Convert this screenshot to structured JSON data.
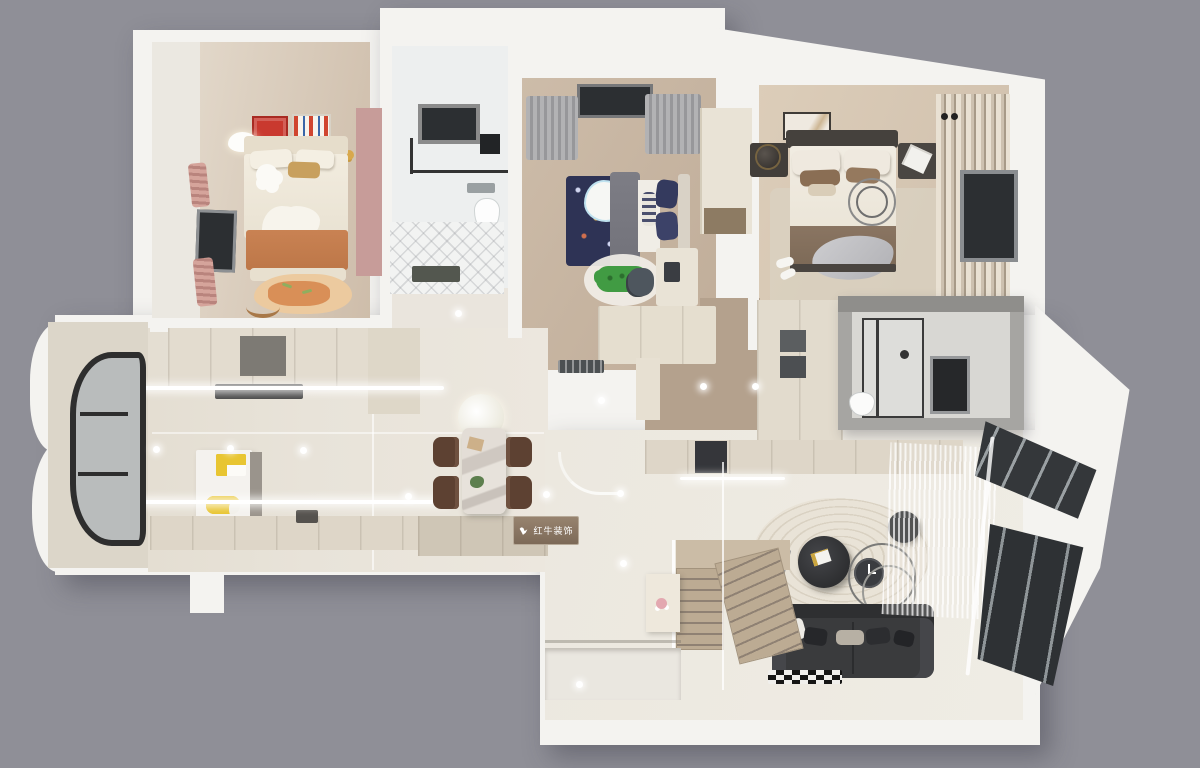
{
  "watermark": {
    "brand": "红牛装饰"
  },
  "scene": {
    "type": "3d-floor-plan-render",
    "view": "top-down dollhouse render on gray backdrop",
    "rooms": [
      {
        "name": "kids-bedroom",
        "items": [
          "single-bed",
          "orange-blanket",
          "fox-rug",
          "pink-accent-wall",
          "wall-posters",
          "cloud-lamp",
          "side-window",
          "pink-curtains"
        ]
      },
      {
        "name": "family-bathroom",
        "items": [
          "black-frame-window",
          "glass-shower",
          "wall-shelf",
          "toilet",
          "diagonal-floor-tiles",
          "doormat"
        ]
      },
      {
        "name": "boys-bedroom",
        "items": [
          "navy-rocket-bed",
          "cloud-duvet-motif",
          "gray-throw",
          "crocodile-rug",
          "desk",
          "desk-chair",
          "wardrobe",
          "gray-curtains",
          "window"
        ]
      },
      {
        "name": "master-bedroom",
        "items": [
          "double-bed",
          "dark-headboard",
          "two-nightstands",
          "table-lamp",
          "wall-art",
          "ring-decor",
          "area-rug",
          "striped-curtains",
          "window",
          "pendant-lights",
          "slippers"
        ]
      },
      {
        "name": "master-bathroom",
        "items": [
          "gray-enclosure",
          "glass-shower-door",
          "toilet",
          "dark-window"
        ]
      },
      {
        "name": "walk-in-closet",
        "items": [
          "cream-wardrobes",
          "open-gray-shelves"
        ]
      },
      {
        "name": "kitchen",
        "items": [
          "upper-counter-run",
          "range-hood",
          "island-with-lemons",
          "lower-counter-run",
          "dark-open-shelf",
          "led-light-strips"
        ]
      },
      {
        "name": "balcony",
        "items": [
          "curved-black-frame-window",
          "wavy-outer-wall"
        ]
      },
      {
        "name": "dining-area",
        "items": [
          "marble-dining-table",
          "four-brown-chairs",
          "round-white-pendant",
          "plant-centerpiece",
          "brand-plaque"
        ]
      },
      {
        "name": "living-room",
        "items": [
          "charcoal-sofa",
          "throw-pillows",
          "round-wave-rug",
          "round-coffee-tables",
          "wire-ring-decor",
          "arc-floor-lamp",
          "checkered-mat",
          "tv-console",
          "sheer-curtains",
          "angled-bay-windows",
          "glass-partition"
        ]
      },
      {
        "name": "staircase",
        "items": [
          "straight-flight",
          "turning-flight",
          "glass-railing",
          "side-cabinet",
          "flower-vase"
        ]
      },
      {
        "name": "entry",
        "items": [
          "steps",
          "dark-doormat",
          "downlights"
        ]
      }
    ]
  },
  "palette": {
    "bg": "#8f8f97",
    "wall": "#f4f3f0",
    "wallBright": "#fbfbfa",
    "wallShade": "#dedcd7",
    "tile": "#e8e3d9",
    "tileLight": "#efece4",
    "marbleTile": "#eae5dd",
    "woodKids": "#cebdaa",
    "woodBoys": "#c0ad99",
    "woodMaster": "#cfbfac",
    "woodHall": "#b4a18d",
    "balconyFloor": "#dcd6c9",
    "pink": "#c79c99",
    "pinkCurtain": "#cf9f97",
    "navy": "#2e3355",
    "grayBlanket": "#72727a",
    "cream": "#e5decf",
    "creamDark": "#cfc6b6",
    "orange": "#bd7748",
    "rugTan": "#ecca9f",
    "foxOrange": "#d98f57",
    "crocGreen": "#419b43",
    "rugWhite": "#f1eee7",
    "marble": "#d7d1ca",
    "chairBrown": "#5d4132",
    "sofa": "#3a3b3d",
    "sofaDark": "#2e2f31",
    "charcoal": "#35363a",
    "glassDark": "#2c2f32",
    "frameGray": "#8d9093",
    "rugCream": "#e9e3d7",
    "rugRing": "#d9d1c2",
    "stairs": "#bcab93",
    "stairsShadow": "#8f8173",
    "grayBox": "#a6a5a2",
    "grayBoxDark": "#8f8e8b",
    "grayBoxInner": "#d8d7d3",
    "lemon": "#e8c531",
    "gold": "#d8a84c",
    "wmText": "#ffffff",
    "posterRed": "#c9392f",
    "matDark": "#53574f",
    "shelfGray": "#5b5e60"
  }
}
